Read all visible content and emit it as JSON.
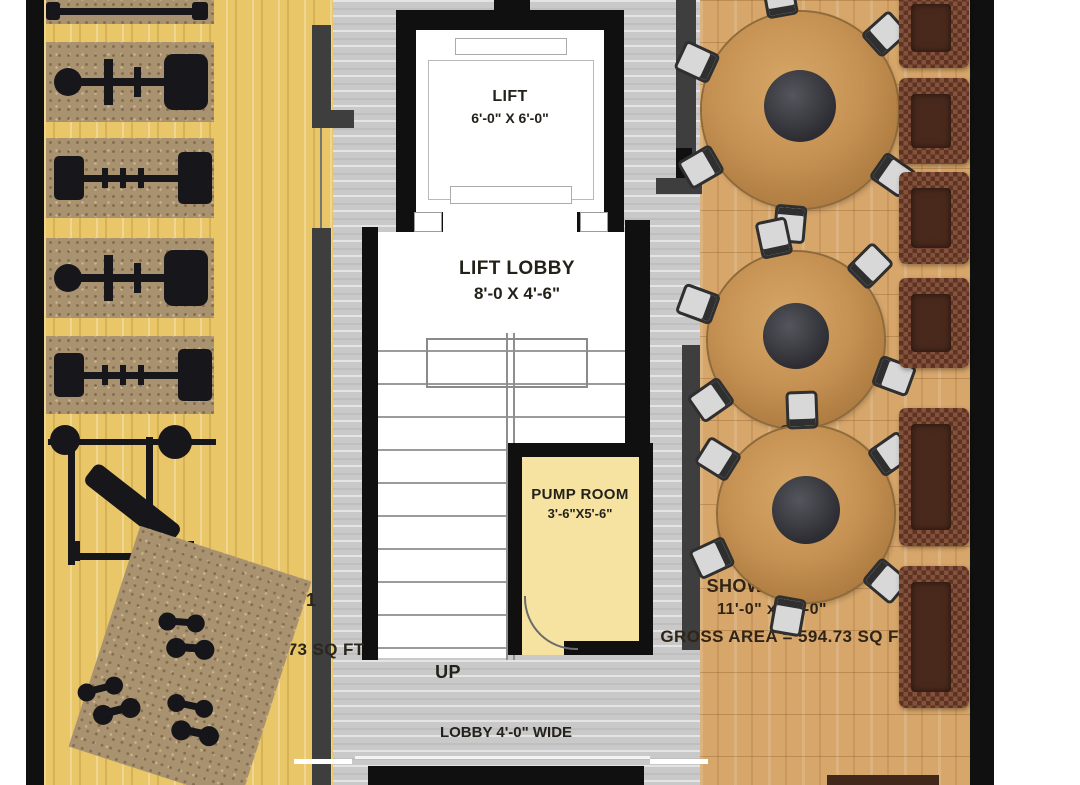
{
  "rooms": {
    "lift": {
      "label": "LIFT",
      "dims": "6'-0\" X 6'-0\""
    },
    "lift_lobby": {
      "label": "LIFT LOBBY",
      "dims": "8'-0 X 4'-6\""
    },
    "pump_room": {
      "label": "PUMP ROOM",
      "dims": "3'-6\"X5'-6\""
    },
    "stair": {
      "up_label": "UP"
    },
    "lobby": {
      "label": "LOBBY 4'-0\" WIDE"
    },
    "showroom1": {
      "label": "SHOWROOM - 1",
      "dims": "11'-0\" x 40'-0\"",
      "area": "GROSS AREA = 594.73 SQ FT"
    },
    "showroom2": {
      "label": "SHOWROOM - 2",
      "dims": "11'-0\" x 40'-0\"",
      "area": "GROSS AREA = 594.73 SQ FT"
    }
  },
  "furniture": {
    "gym_machine_mats": 5,
    "bench_press_sets": 1,
    "dumbbell_clusters": 3,
    "round_tables": 3,
    "chairs_per_table": 6,
    "sofas": 6
  },
  "colors": {
    "outer_wall": "#101010",
    "partition_wall": "#3e3e3e",
    "showroom1_floor": "#e9c668",
    "showroom2_floor": "#d7a66a",
    "core_floor": "#c9c9c9",
    "pump_room_floor": "#f6e3a1",
    "sofa": "#6e4130",
    "table_wood": "#c89356"
  }
}
